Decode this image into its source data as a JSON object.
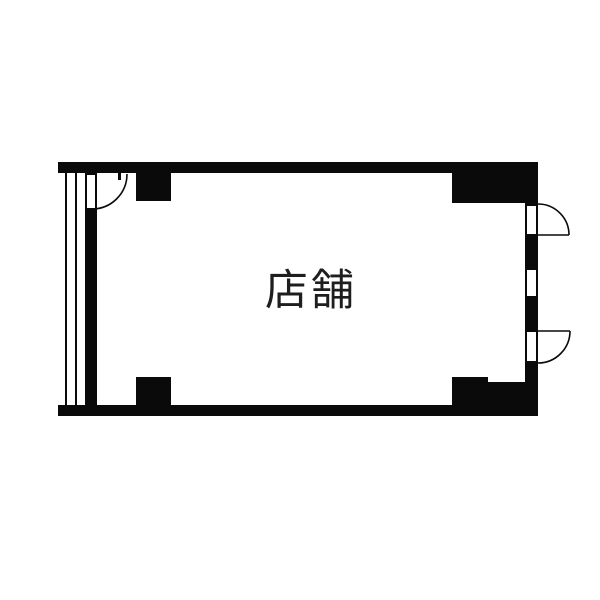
{
  "room": {
    "label": "店舗"
  },
  "colors": {
    "wall": "#0a0a0a",
    "background": "#ffffff",
    "label": "#1e1e1e"
  }
}
